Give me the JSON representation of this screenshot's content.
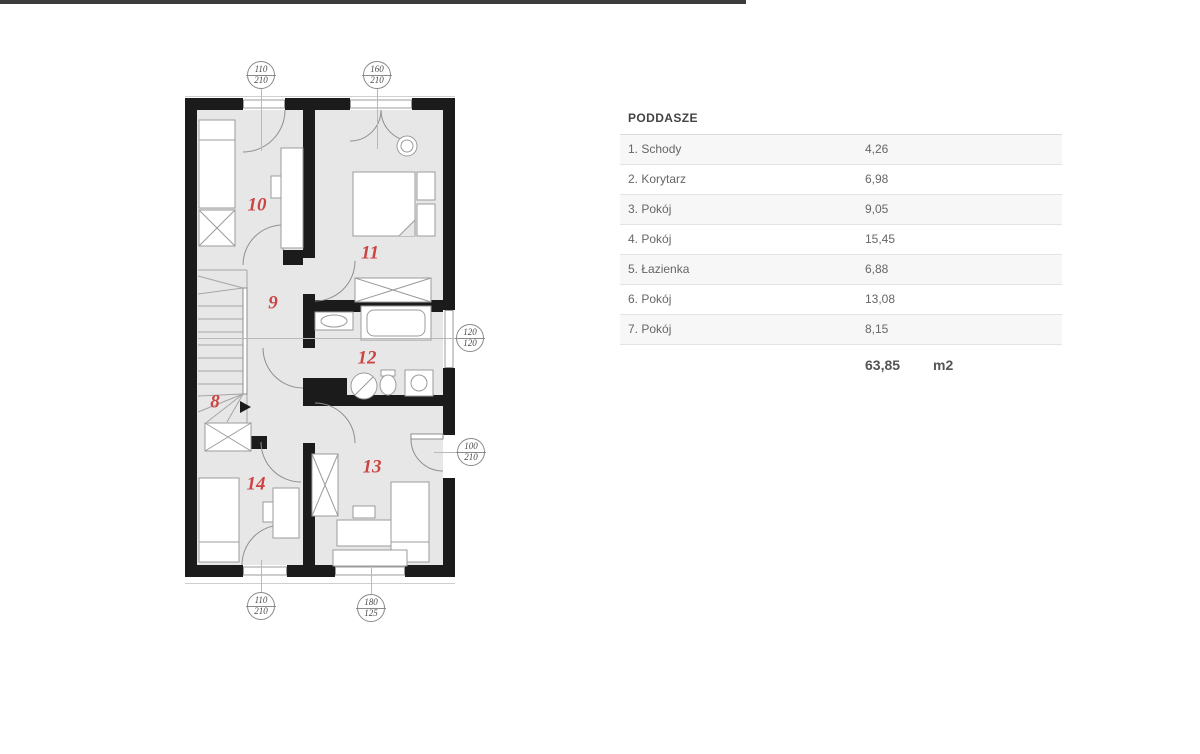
{
  "top_bar": {
    "color": "#3b3b3b"
  },
  "colors": {
    "wall": "#1b1b1b",
    "room_fill": "#e7e7e7",
    "room_number_red": "#cc4444"
  },
  "floor_plan": {
    "rooms": [
      {
        "number": "8"
      },
      {
        "number": "9"
      },
      {
        "number": "10"
      },
      {
        "number": "11"
      },
      {
        "number": "12"
      },
      {
        "number": "13"
      },
      {
        "number": "14"
      }
    ],
    "dimension_markers": [
      {
        "top": "110",
        "bottom": "210"
      },
      {
        "top": "160",
        "bottom": "210"
      },
      {
        "top": "120",
        "bottom": "120"
      },
      {
        "top": "100",
        "bottom": "210"
      },
      {
        "top": "110",
        "bottom": "210"
      },
      {
        "top": "180",
        "bottom": "125"
      }
    ]
  },
  "area_table": {
    "title": "PODDASZE",
    "rows": [
      {
        "label": "1. Schody",
        "value": "4,26"
      },
      {
        "label": "2. Korytarz",
        "value": "6,98"
      },
      {
        "label": "3. Pokój",
        "value": "9,05"
      },
      {
        "label": "4. Pokój",
        "value": "15,45"
      },
      {
        "label": "5. Łazienka",
        "value": "6,88"
      },
      {
        "label": "6. Pokój",
        "value": "13,08"
      },
      {
        "label": "7. Pokój",
        "value": "8,15"
      }
    ],
    "total": {
      "value": "63,85",
      "unit": "m2"
    }
  }
}
